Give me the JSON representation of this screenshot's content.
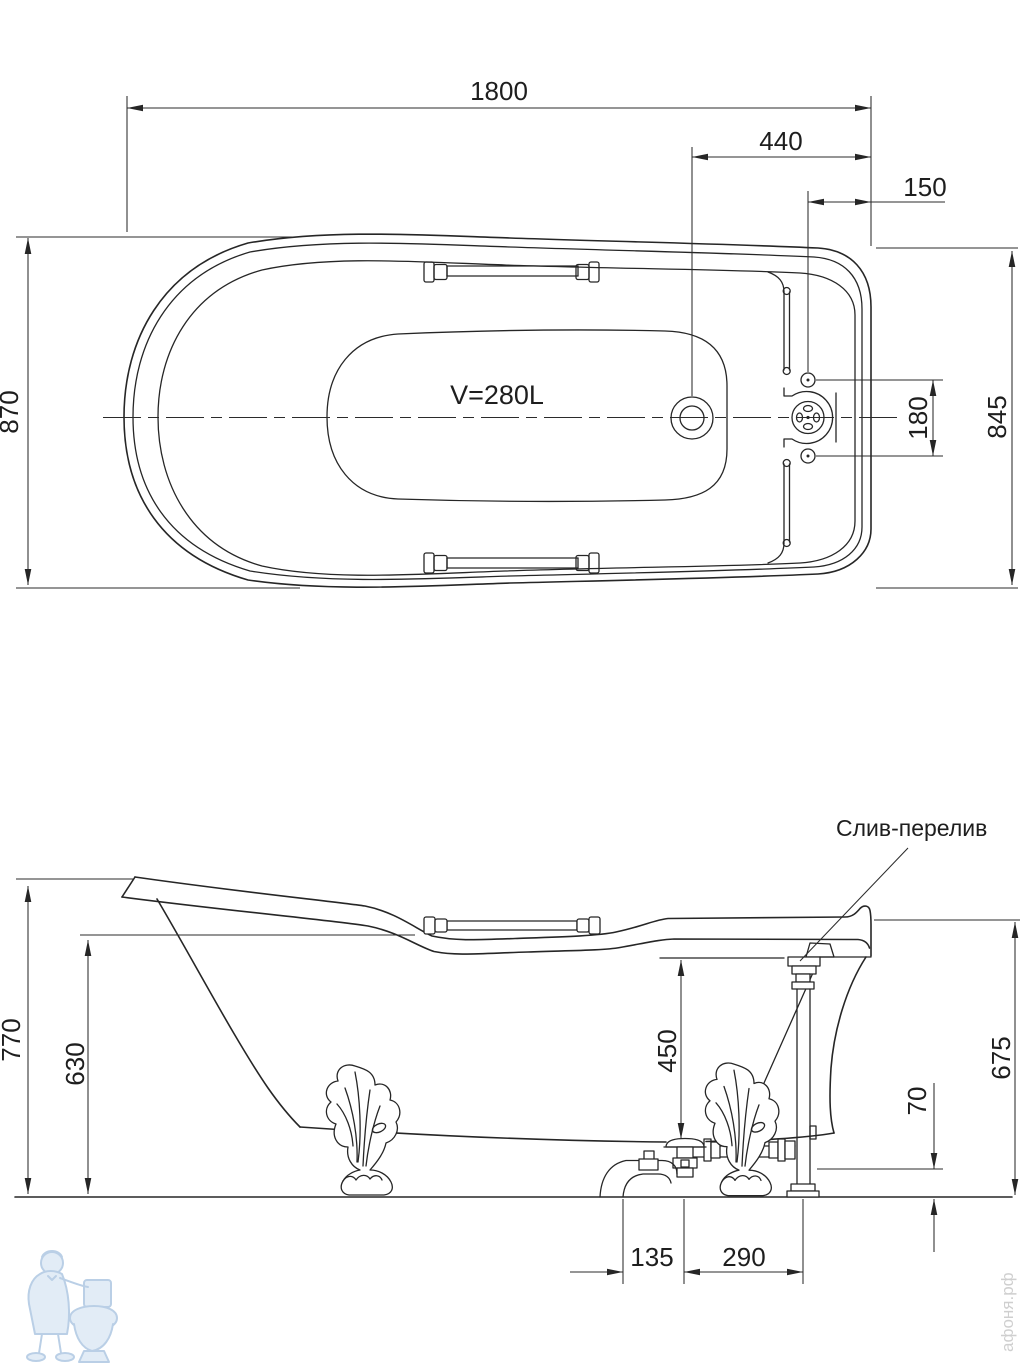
{
  "plan_view": {
    "volume_label": "V=280L",
    "dim_length": "1800",
    "dim_drain_to_end": "440",
    "dim_overflow_to_end": "150",
    "dim_width_left": "870",
    "dim_width_right": "845",
    "dim_hole_spacing": "180"
  },
  "side_view": {
    "overflow_label": "Слив-перелив",
    "dim_height_back": "770",
    "dim_height_rim": "630",
    "dim_depth": "450",
    "dim_height_right": "675",
    "dim_pipe_clearance": "70",
    "dim_trap_to_drain": "135",
    "dim_drain_to_column": "290"
  },
  "watermark": {
    "site": "афоня.рф"
  }
}
